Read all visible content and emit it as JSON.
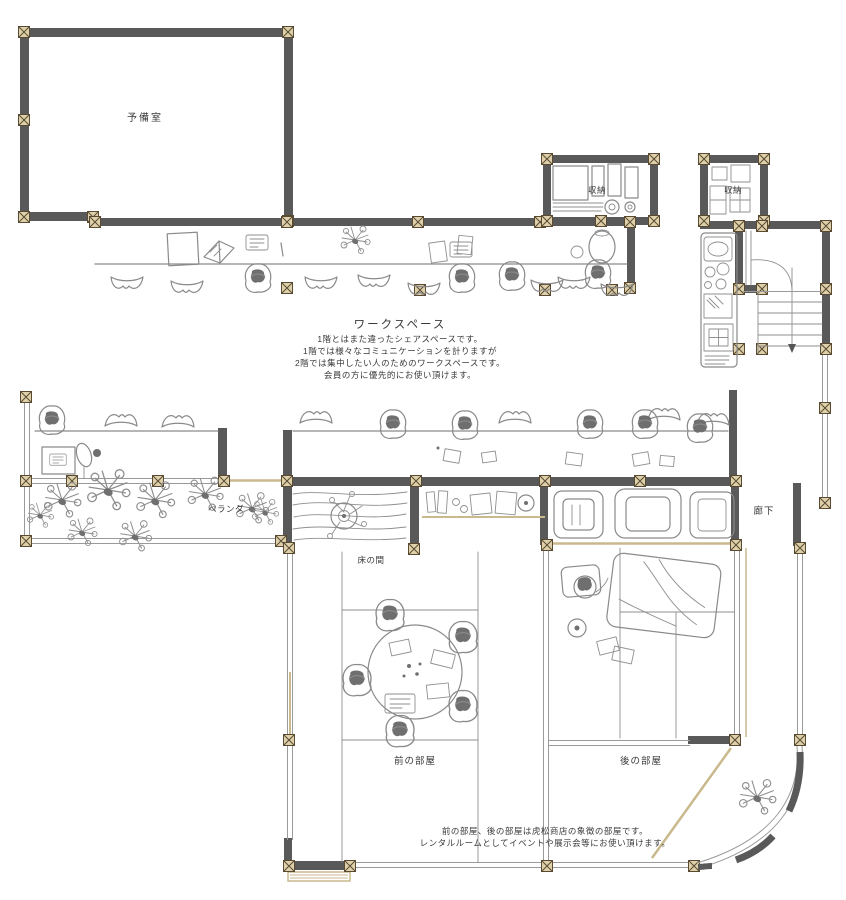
{
  "labels": {
    "spare_room": "予備室",
    "storage_1": "収納",
    "storage_2": "収納",
    "veranda": "ベランダ",
    "tokonoma": "床の間",
    "front_room": "前の部屋",
    "back_room": "後の部屋",
    "corridor": "廊下"
  },
  "workspace": {
    "title": "ワークスペース",
    "desc": [
      "1階とはまた違ったシェアスペースです。",
      "1階では様々なコミュニケーションを計りますが",
      "2階では集中したい人のためのワークスペースです。",
      "会員の方に優先的にお使い頂けます。"
    ]
  },
  "note": {
    "lines": [
      "前の部屋、後の部屋は虎松商店の象徴の部屋です。",
      "レンタルルームとしてイベントや展示会等にお使い頂けます。"
    ]
  },
  "colors": {
    "wall": "#595959",
    "sketch": "#8a8a8a",
    "column_fill": "#ddd0ab",
    "column_stroke": "#5a4a32",
    "accent_tan": "#c9b98d",
    "text": "#3a3a3a",
    "background": "#ffffff"
  }
}
